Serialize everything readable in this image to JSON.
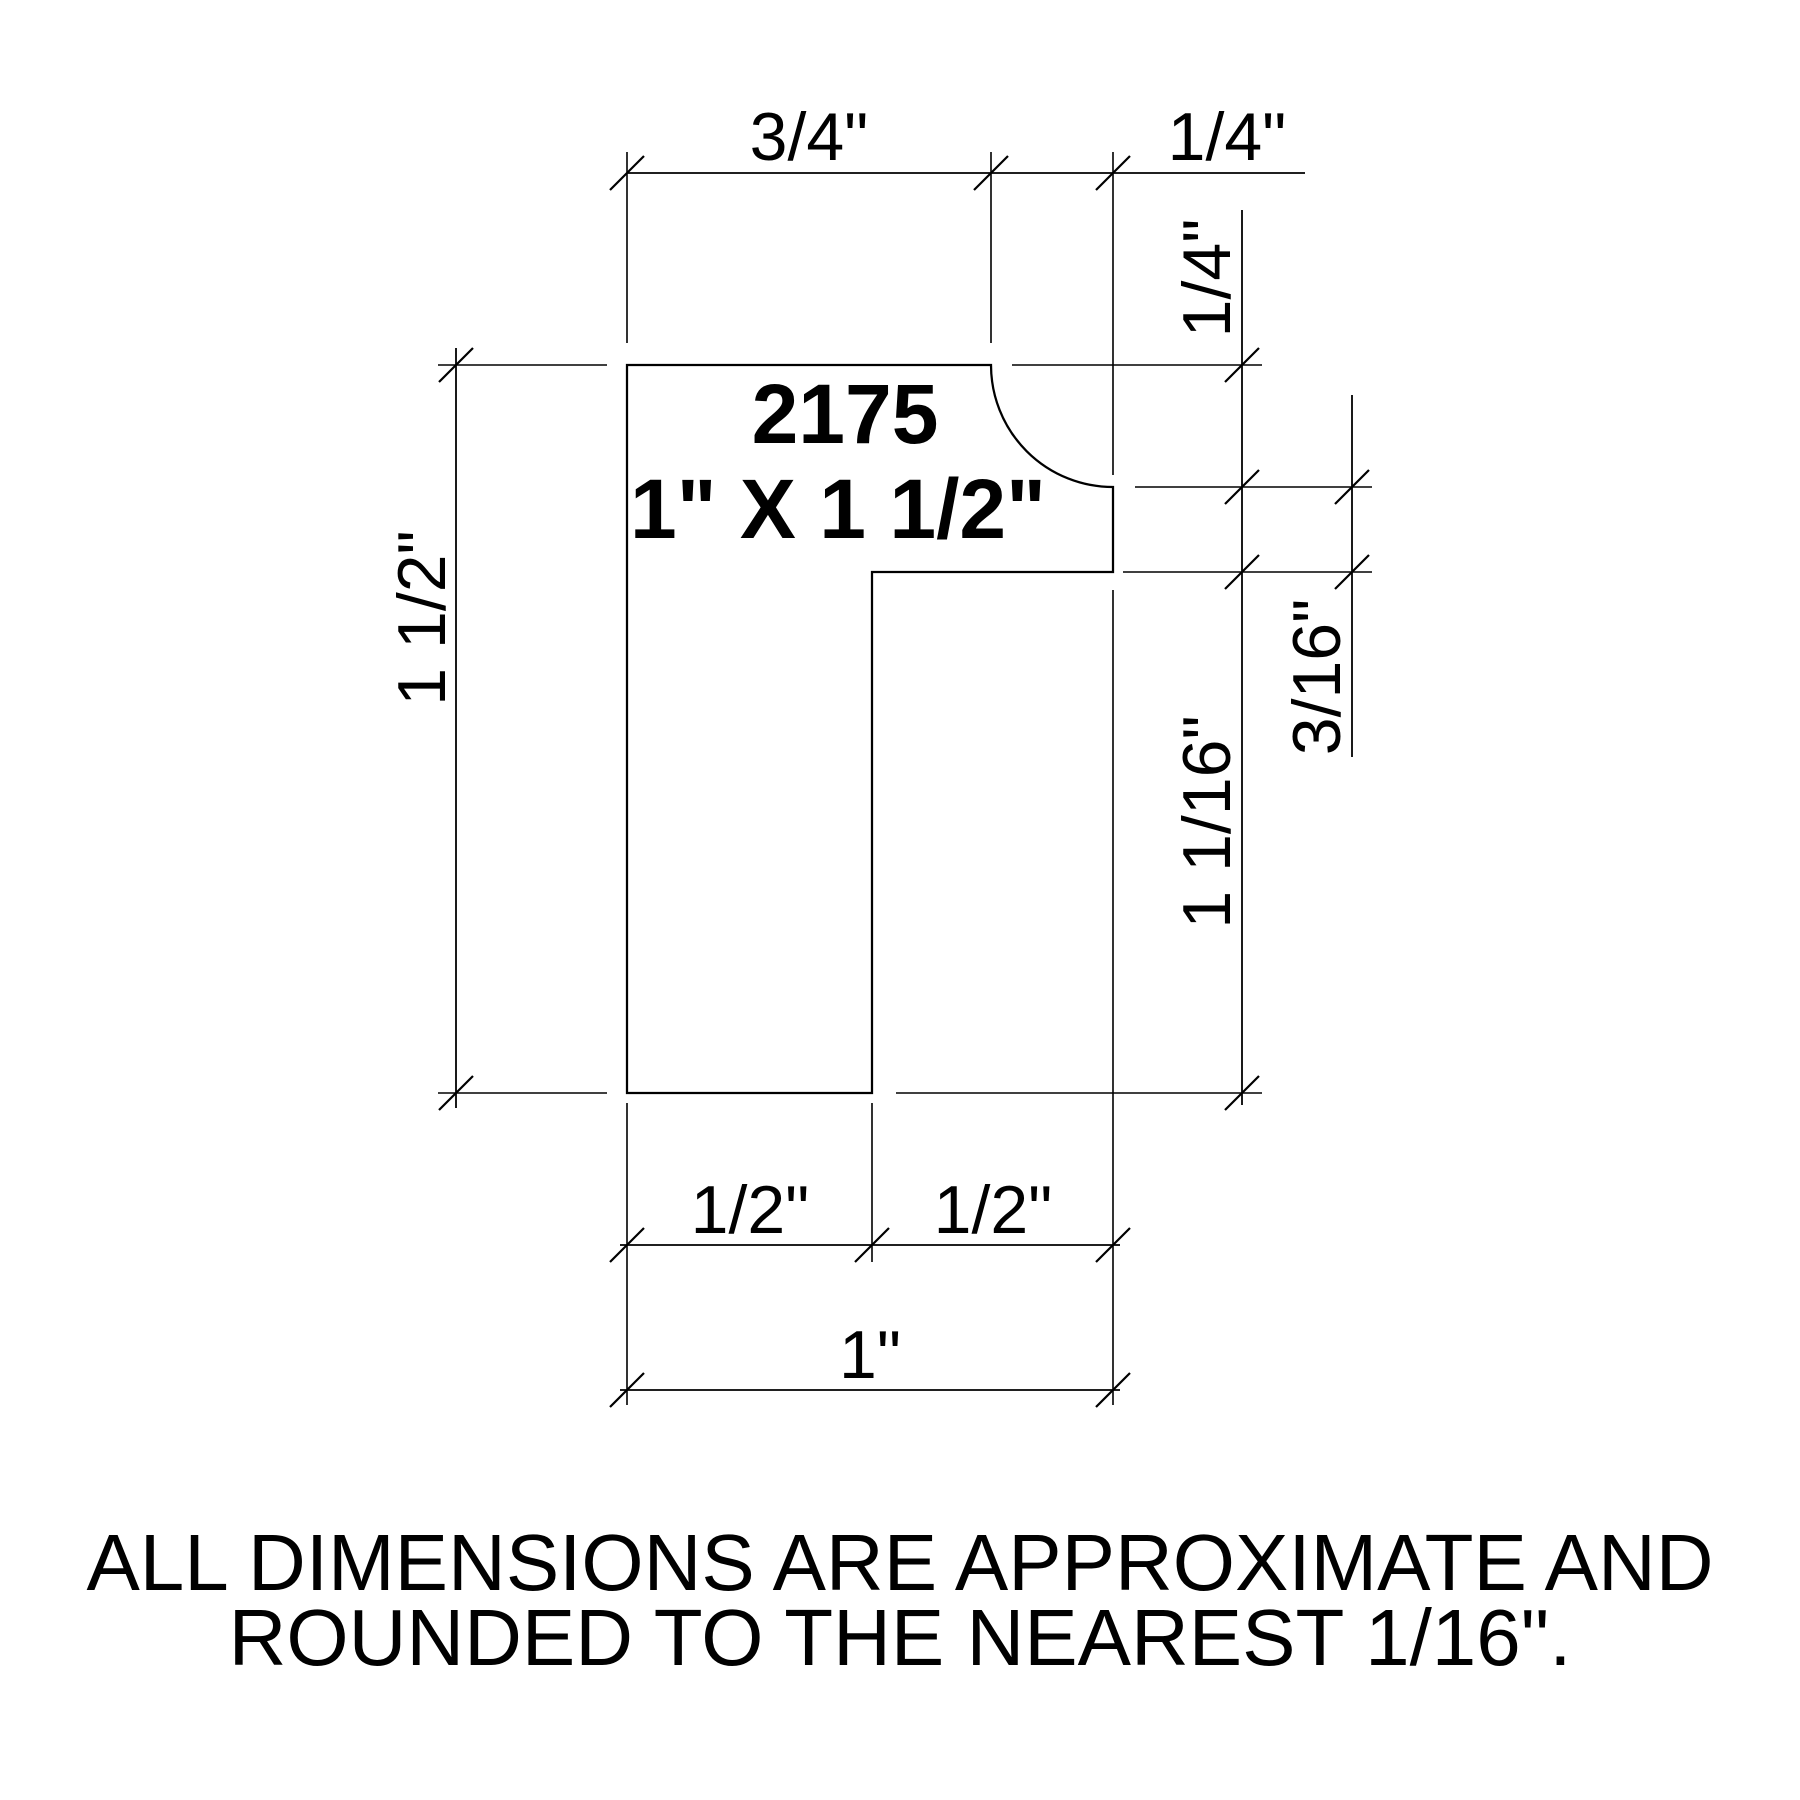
{
  "drawing": {
    "part_number": "2175",
    "size_label": "1\" X 1 1/2\"",
    "dimensions": {
      "top_flat_width": "3/4\"",
      "top_cove_width": "1/4\"",
      "cove_depth": "1/4\"",
      "right_step": "3/16\"",
      "notch_height": "1 1/16\"",
      "overall_height": "1 1/2\"",
      "bottom_left_half": "1/2\"",
      "bottom_right_half": "1/2\"",
      "overall_width": "1\""
    },
    "note": {
      "line1": "ALL DIMENSIONS ARE APPROXIMATE AND",
      "line2": "ROUNDED TO THE NEAREST 1/16\"."
    },
    "colors": {
      "line": "#000000",
      "background": "#ffffff"
    }
  }
}
